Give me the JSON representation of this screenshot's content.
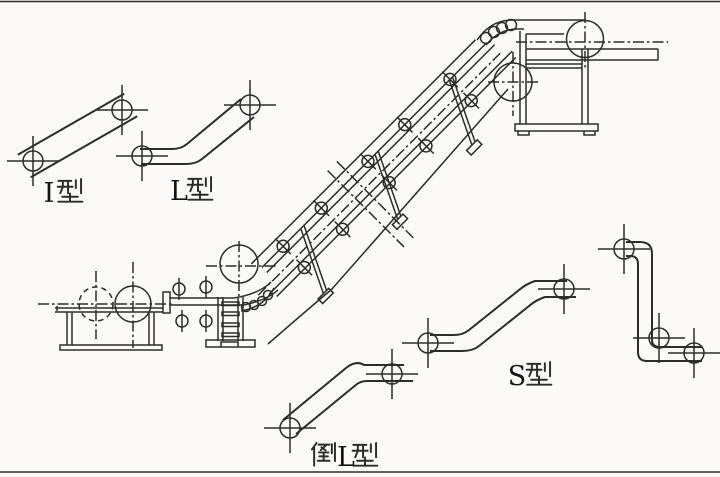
{
  "image": {
    "kind": "scanned technical diagram of conveyor type configurations",
    "background_color": "#fbfaf8",
    "line_color": "#2c2c2c",
    "frame_line_color": "#c6c6c6"
  },
  "labels": {
    "i_type": {
      "label": "I型",
      "latin": "I"
    },
    "l_type": {
      "label": "L型",
      "latin": "L"
    },
    "inverted_l_type": {
      "label": "倒L型",
      "latin": "L"
    },
    "s_type": {
      "label": "S型",
      "latin": "S"
    }
  }
}
